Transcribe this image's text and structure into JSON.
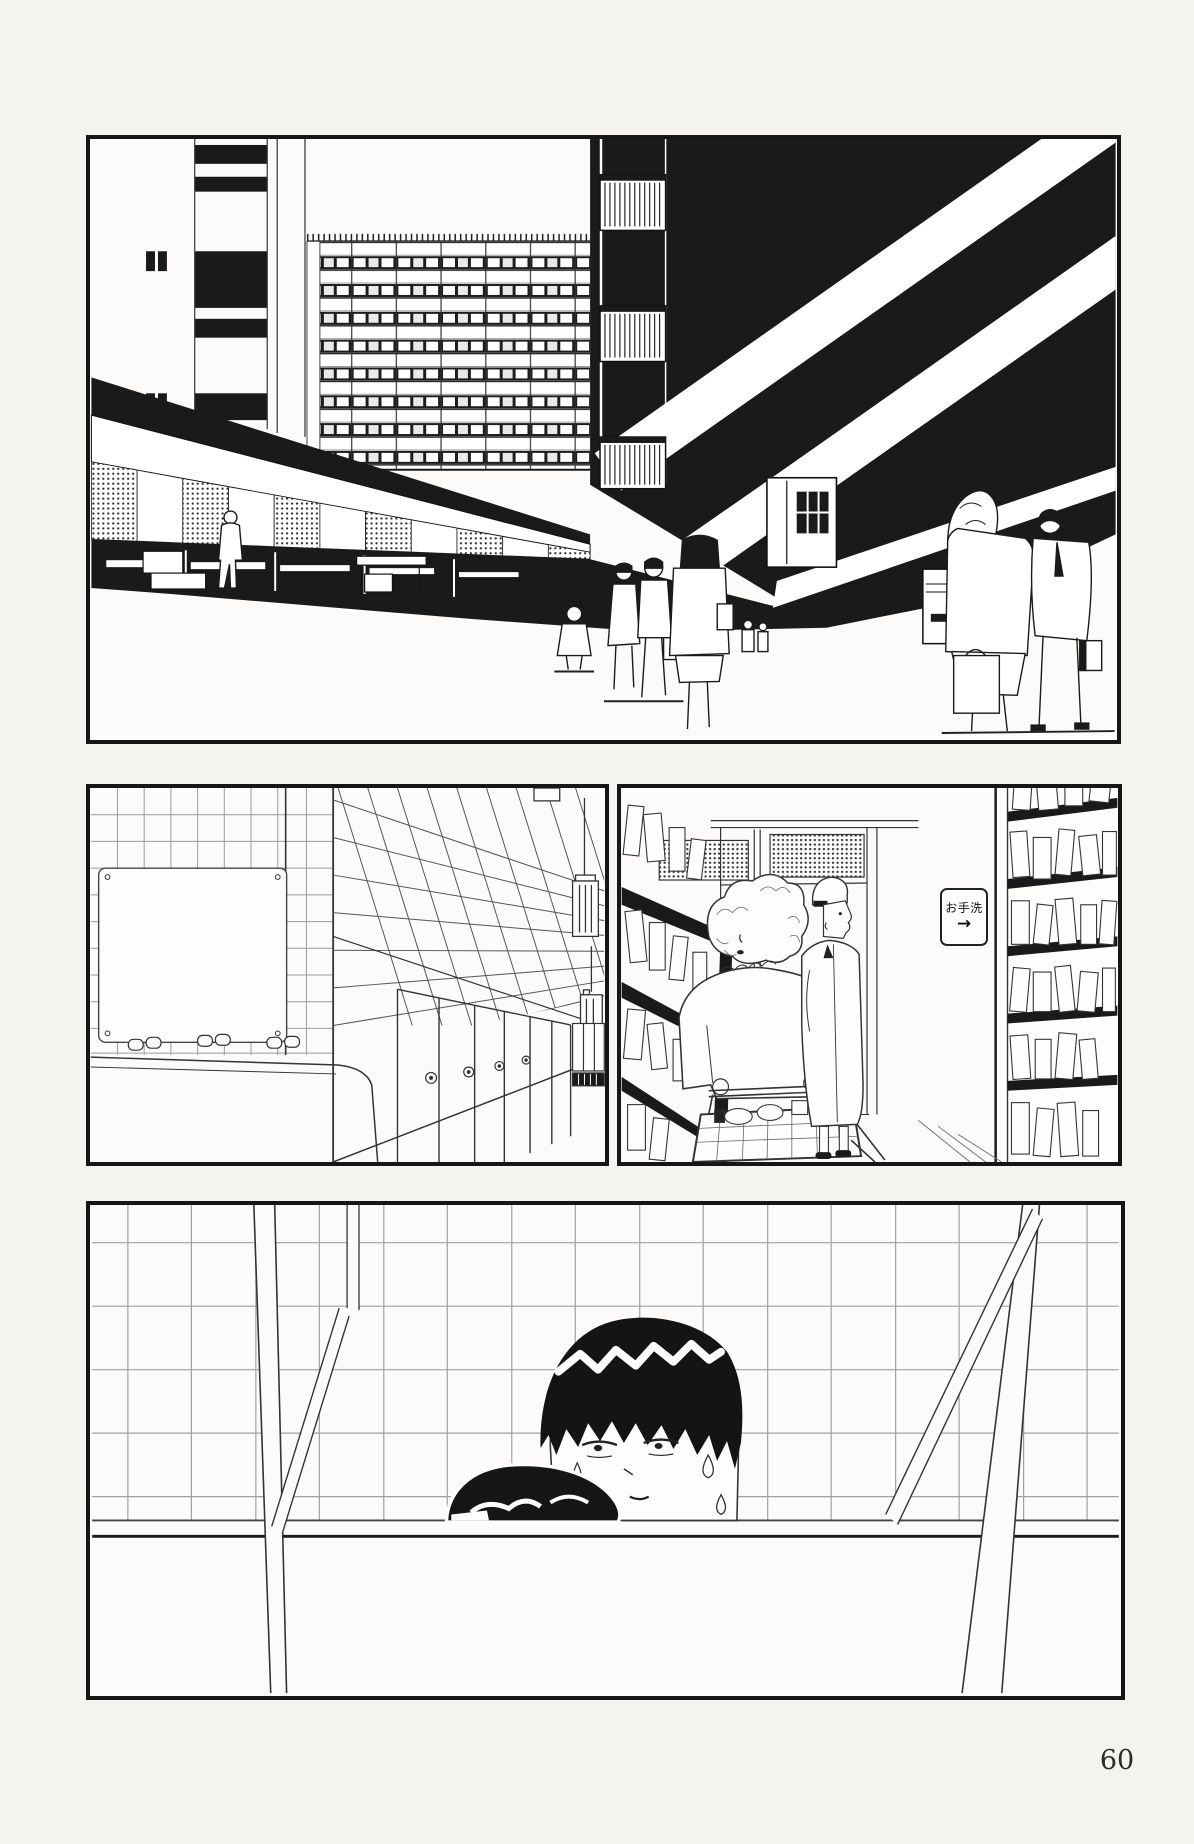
{
  "page": {
    "number": "60"
  },
  "colors": {
    "ink": "#1a1a1a",
    "paper": "#f5f3ef",
    "panel_bg": "#fcfbf9",
    "tile_line": "#8a8a8a"
  },
  "restroom_sign": {
    "text": "お手洗",
    "arrow": "→"
  },
  "icons": {
    "restroom_arrow_icon": "→"
  }
}
